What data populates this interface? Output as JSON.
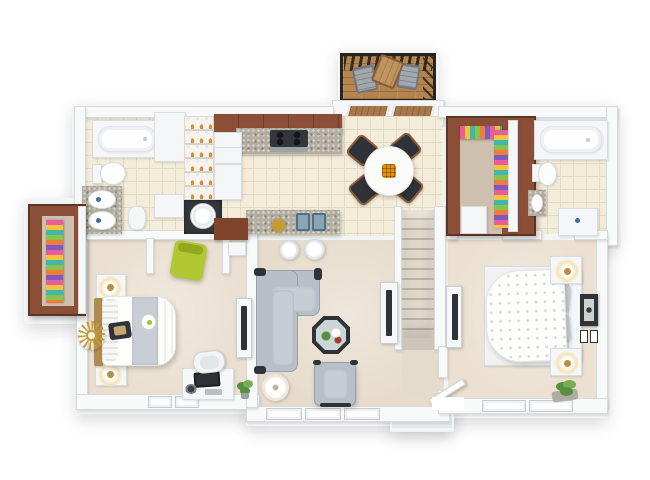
{
  "scene": {
    "type": "3d-floor-plan-render",
    "view": "top-down",
    "description": "Top-down 3D render of a two-bedroom apartment floor plan on a white background; no text is visible in the image",
    "background": "#ffffff"
  },
  "palette": {
    "slab": "#f2f4f5",
    "wall": "#f8fafa",
    "wallEdge": "#d7dbde",
    "tile": "#f3ecd9",
    "tileLine": "#e2dac4",
    "carpetBed1": "#eadfd0",
    "carpetLiving": "#e7dccc",
    "carpetBed2": "#ebe0d1",
    "hallFloor": "#e5dbcb",
    "closetFloor": "#cec0ae",
    "wood": "#8a4f36",
    "woodDark": "#5e3424",
    "woodLight": "#a8784c",
    "islandWood": "#7e452c",
    "deckWood": "#b5854f",
    "deckFrame": "#29241f",
    "granite": "#b3ada2",
    "appliance": "#33373c",
    "steel": "#9ba2a8",
    "sinkSteel": "#8ba4b4",
    "sinkEdge": "#4e7187",
    "sofa": "#b7bfc9",
    "sofaSeat": "#c6cdd4",
    "frameDark": "#2f3338",
    "accentGreen": "#b2c832",
    "runner": "#c9ced4",
    "duvetDot": "#d8d8d5",
    "glow": "#f5e4b5",
    "gold": "#c49b35",
    "lampGold": "#b98f3e",
    "stairLight": "#ded7ca",
    "stairDark": "#bab2a3",
    "leaf": "#55903f",
    "leafLight": "#79ad52",
    "orange": "#e2910f",
    "tanWood": "#b08a4f",
    "chairWood": "#8a5a3b",
    "clothes": [
      "#e85d9a",
      "#f3c53d",
      "#3fb7ac",
      "#8bc34a",
      "#ef7c3a",
      "#7d59c0"
    ]
  },
  "rooms": [
    {
      "id": "bathroom-1",
      "position": "top-left",
      "furniture": [
        "bathtub",
        "toilet",
        "double-sink-vanity",
        "linen-cabinets",
        "pedestal-fixture"
      ]
    },
    {
      "id": "pantry",
      "position": "top-left-center",
      "furniture": [
        "shelving-with-jars"
      ]
    },
    {
      "id": "laundry-closet",
      "position": "top-center-left",
      "furniture": [
        "washer"
      ]
    },
    {
      "id": "kitchen",
      "position": "top-center",
      "furniture": [
        "upper-wood-cabinets",
        "range-with-4-burners",
        "refrigerator",
        "tall-cabinet",
        "granite-island",
        "double-sink",
        "two-bar-stools",
        "gold-decor"
      ]
    },
    {
      "id": "dining-area",
      "position": "top-center-right",
      "furniture": [
        "round-white-table",
        "orange-centerpiece",
        "four-dark-wood-chairs"
      ]
    },
    {
      "id": "deck",
      "position": "top-above-dining",
      "furniture": [
        "pergola-slats",
        "two-folding-chairs",
        "small-table",
        "sliding-glass-door"
      ]
    },
    {
      "id": "walk-in-closet",
      "position": "top-right-center",
      "furniture": [
        "hanging-clothes-two-rows",
        "dresser"
      ]
    },
    {
      "id": "bathroom-2",
      "position": "top-right",
      "furniture": [
        "bathtub",
        "toilet",
        "granite-cabinet",
        "vanity"
      ]
    },
    {
      "id": "bedroom-1",
      "position": "bottom-left",
      "furniture": [
        "bed-with-gray-runner",
        "ruffled-pillows",
        "two-nightstands-with-lamps",
        "sunburst-mirror",
        "reach-in-closet-with-clothes",
        "green-accent-chair",
        "desk-with-computer",
        "desk-chair",
        "tv-console",
        "plant"
      ]
    },
    {
      "id": "living-room",
      "position": "bottom-center",
      "furniture": [
        "l-shaped-gray-sectional",
        "octagonal-glass-coffee-table-with-plants",
        "gray-armchair",
        "drum-floor-lamp",
        "tv-console",
        "entry-console"
      ]
    },
    {
      "id": "staircase",
      "position": "center-right",
      "furniture": [
        "straight-stairs"
      ]
    },
    {
      "id": "entry",
      "position": "bottom-center-right",
      "furniture": [
        "open-front-door",
        "porch-landing"
      ]
    },
    {
      "id": "bedroom-2",
      "position": "bottom-right",
      "furniture": [
        "bed-with-polka-dot-duvet",
        "headboard-with-pillows",
        "two-nightstands-with-lamps",
        "tv-console",
        "framed-wall-art",
        "two-small-frames",
        "plant"
      ]
    }
  ]
}
